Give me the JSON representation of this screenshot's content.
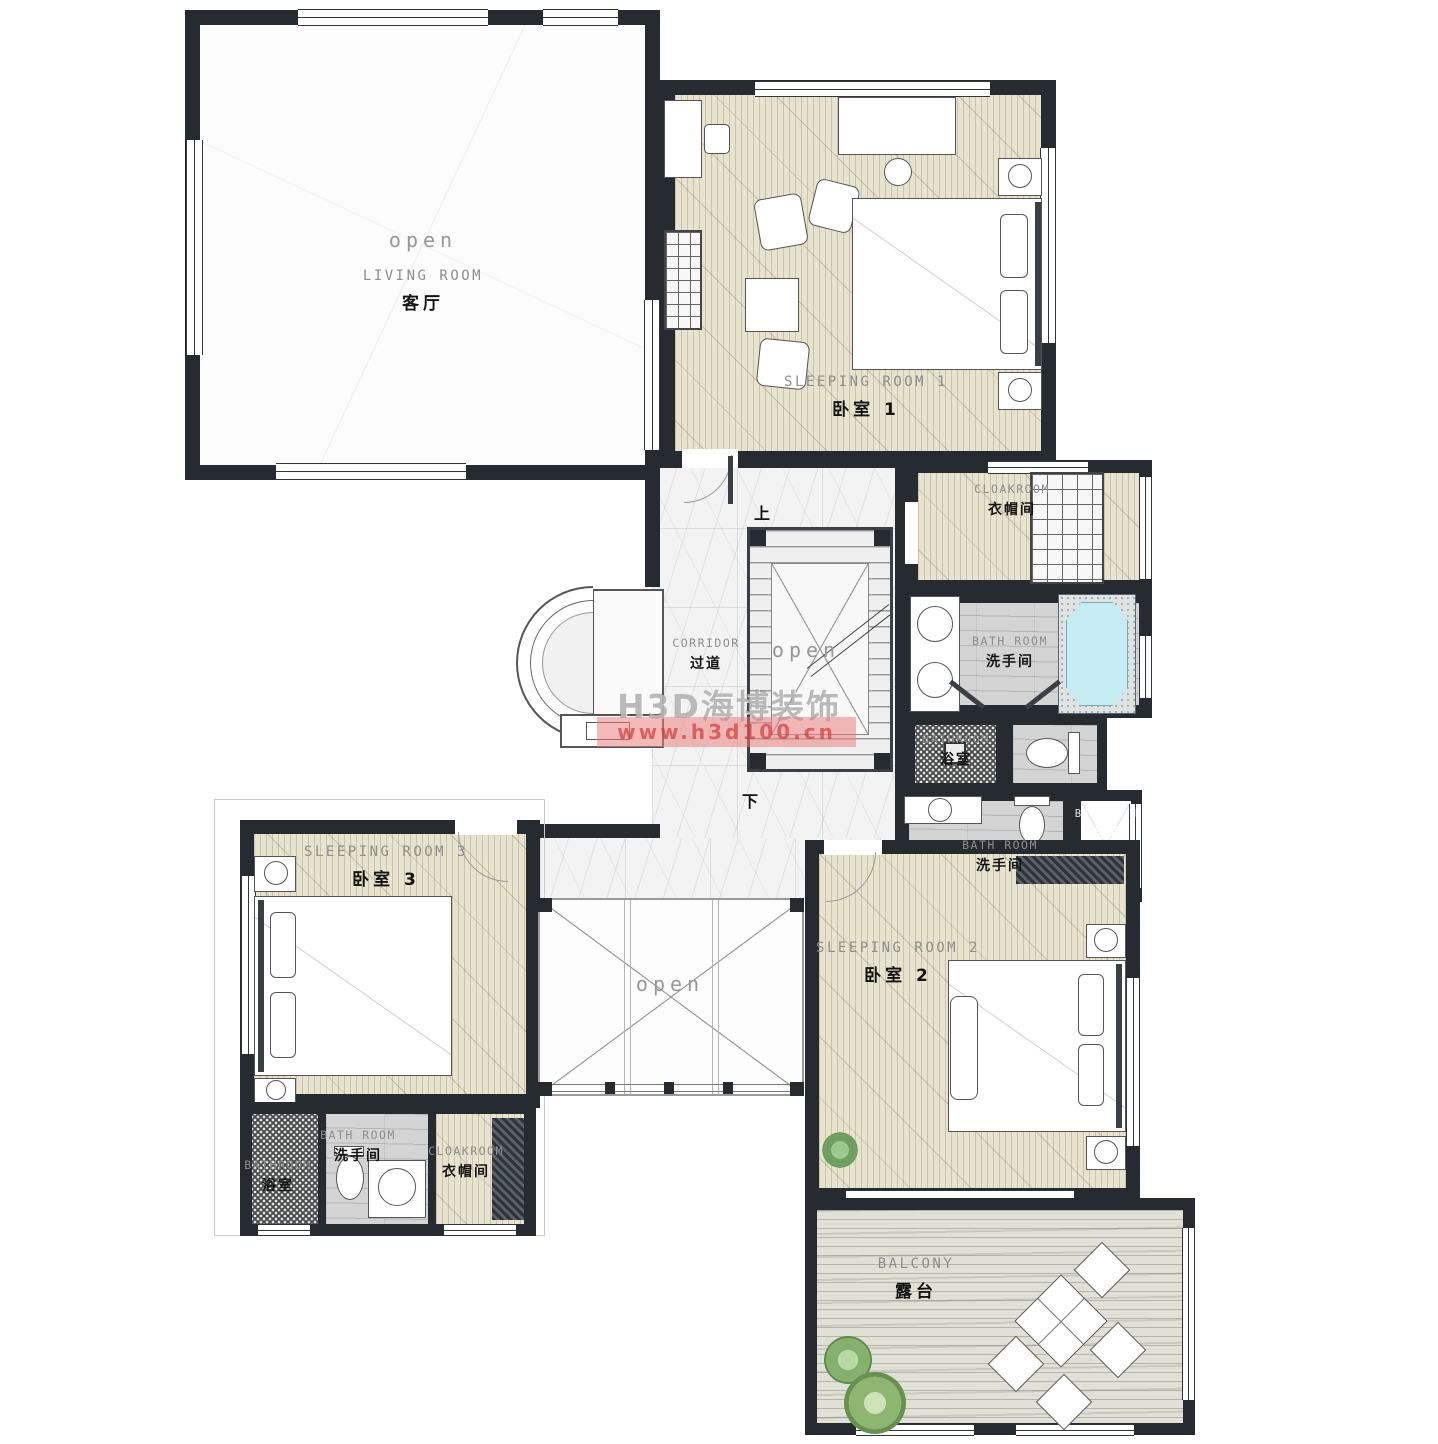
{
  "watermark": {
    "brand": "H3D海博装饰",
    "url": "www.h3d100.cn"
  },
  "labels": {
    "living_room": {
      "open": "open",
      "en": "LIVING ROOM",
      "zh": "客厅"
    },
    "sleeping_room_1": {
      "en": "SLEEPING ROOM 1",
      "zh": "卧室 1"
    },
    "cloakroom_master": {
      "en": "CLOAKROOM",
      "zh": "衣帽间"
    },
    "bath_room_master": {
      "en": "BATH ROOM",
      "zh": "洗手间"
    },
    "bathroom_master_shower": {
      "en": "BATHROOM",
      "zh": "浴室"
    },
    "corridor": {
      "en": "CORRIDOR",
      "zh": "过道"
    },
    "stairs": {
      "open": "open",
      "up": "上",
      "down": "下"
    },
    "bath_room_guest": {
      "en": "BATH ROOM",
      "zh": "洗手间"
    },
    "bathroom_guest_shower": {
      "en": "BATHROOM",
      "zh": "浴室"
    },
    "sleeping_room_3": {
      "en": "SLEEPING ROOM 3",
      "zh": "卧室 3"
    },
    "bathroom_3_shower": {
      "en": "BATHROOM",
      "zh": "浴室"
    },
    "bath_room_3": {
      "en": "BATH ROOM",
      "zh": "洗手间"
    },
    "cloakroom_3": {
      "en": "CLOAKROOM",
      "zh": "衣帽间"
    },
    "open_void": {
      "open": "open"
    },
    "sleeping_room_2": {
      "en": "SLEEPING ROOM 2",
      "zh": "卧室 2"
    },
    "balcony": {
      "en": "BALCONY",
      "zh": "露台"
    }
  },
  "colors": {
    "wall": "#262b31",
    "floor_bedroom": "#e8e3cf",
    "floor_bath": "#d4d4d4",
    "floor_marble": "#f3f3f3",
    "floor_balcony": "#e1e0d6",
    "bathtub_blue": "#c5ebf3",
    "watermark_red": "#d23c3c"
  }
}
